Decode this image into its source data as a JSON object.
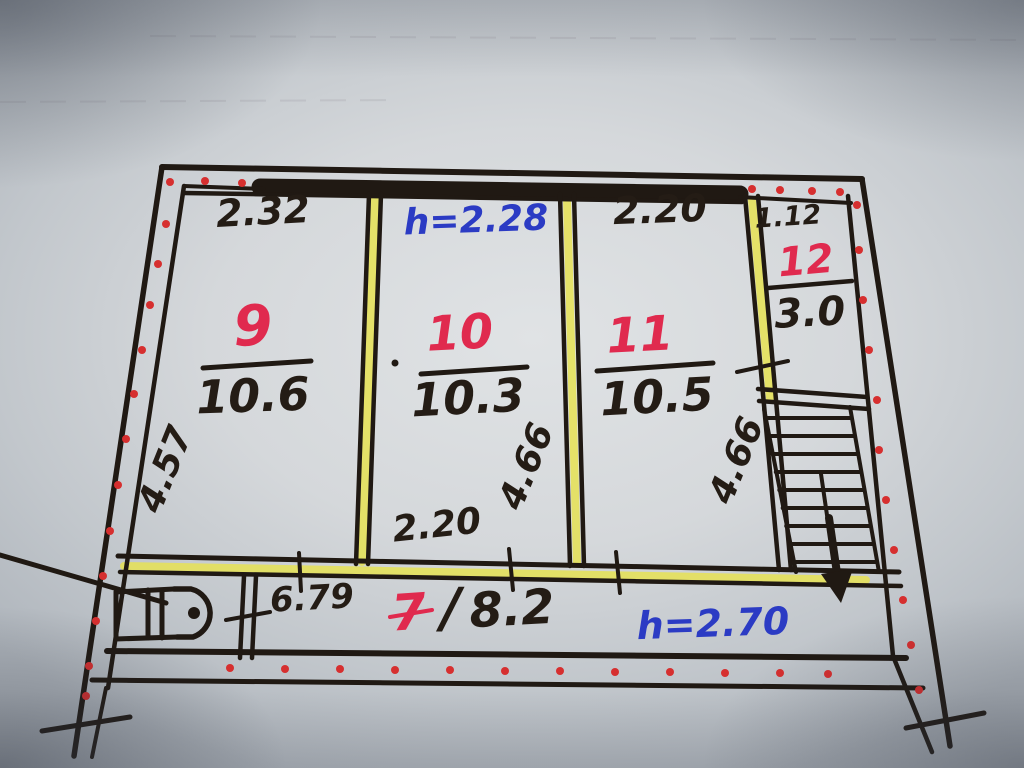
{
  "floor_plan": {
    "rooms": [
      {
        "number": "9",
        "area": "10.6"
      },
      {
        "number": "10",
        "area": "10.3"
      },
      {
        "number": "11",
        "area": "10.5"
      },
      {
        "number": "12",
        "area": "3.0"
      },
      {
        "number": "7",
        "separator": "/",
        "area": "8.2"
      }
    ],
    "dimensions": {
      "room9_width_top": "2.32",
      "room11_width_top": "2.20",
      "room12_width_top": "1.12",
      "room9_depth_left": "4.57",
      "room10_depth_right": "4.66",
      "room11_depth_right": "4.66",
      "room10_width_bottom": "2.20",
      "corridor_length": "6.79"
    },
    "ceiling_heights": {
      "upper_rooms": "h=2.28",
      "corridor": "h=2.70"
    },
    "colors": {
      "ink_black": "#201913",
      "number_red": "#e02a4e",
      "height_blue": "#2b3bc4",
      "highlighter_yellow": "#e6e254",
      "insulation_dot_red": "#d62f2f"
    }
  }
}
